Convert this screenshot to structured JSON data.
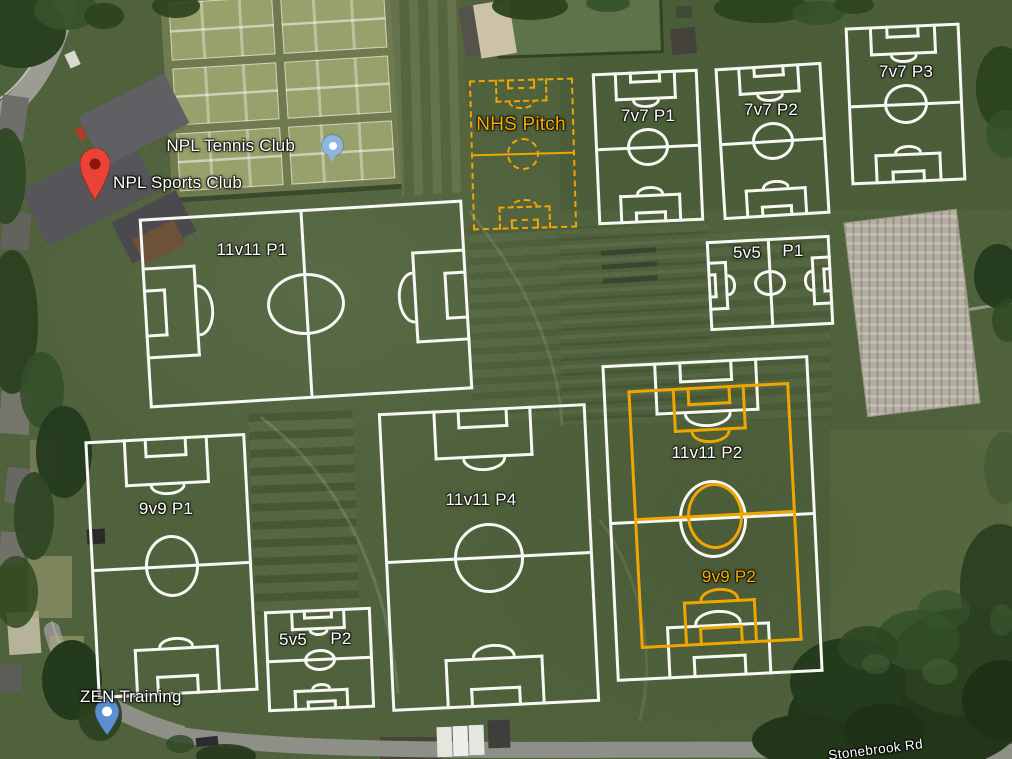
{
  "colors": {
    "pitch_line_white": "#F7F7F4",
    "pitch_line_orange": "#F0A500",
    "pitch_label_orange": "#F7AC00",
    "marker_red": "#EA4335",
    "marker_red_dot": "#8A150A",
    "poi_blue": "#8FB5DC",
    "poi_pin_blue": "#5B8FD0",
    "grass": "#51633D"
  },
  "markers": [
    {
      "id": "npl-tennis-club",
      "label": "NPL Tennis Club",
      "type": "poi-dot"
    },
    {
      "id": "npl-sports-club",
      "label": "NPL Sports Club",
      "type": "red-pin"
    },
    {
      "id": "zen-training",
      "label": "ZEN Training",
      "type": "poi-pin"
    }
  ],
  "roads": [
    {
      "id": "stonebrook",
      "label": "Stonebrook Rd"
    }
  ],
  "pitches": [
    {
      "id": "11v11-p1",
      "label": "11v11 P1",
      "color": "white",
      "style": "solid"
    },
    {
      "id": "nhs-pitch",
      "label": "NHS Pitch",
      "color": "orange",
      "style": "dashed"
    },
    {
      "id": "7v7-p1",
      "label": "7v7 P1",
      "color": "white",
      "style": "solid"
    },
    {
      "id": "7v7-p2",
      "label": "7v7 P2",
      "color": "white",
      "style": "solid"
    },
    {
      "id": "7v7-p3",
      "label": "7v7 P3",
      "color": "white",
      "style": "solid"
    },
    {
      "id": "5v5-p1",
      "label_parts": [
        "5v5",
        "P1"
      ],
      "color": "white",
      "style": "solid"
    },
    {
      "id": "11v11-p2",
      "label": "11v11 P2",
      "color": "white",
      "style": "solid"
    },
    {
      "id": "9v9-p2",
      "label": "9v9 P2",
      "color": "orange",
      "style": "solid"
    },
    {
      "id": "9v9-p1",
      "label": "9v9 P1",
      "color": "white",
      "style": "solid"
    },
    {
      "id": "11v11-p4",
      "label": "11v11 P4",
      "color": "white",
      "style": "solid"
    },
    {
      "id": "5v5-p2",
      "label_parts": [
        "5v5",
        "P2"
      ],
      "color": "white",
      "style": "solid"
    }
  ]
}
